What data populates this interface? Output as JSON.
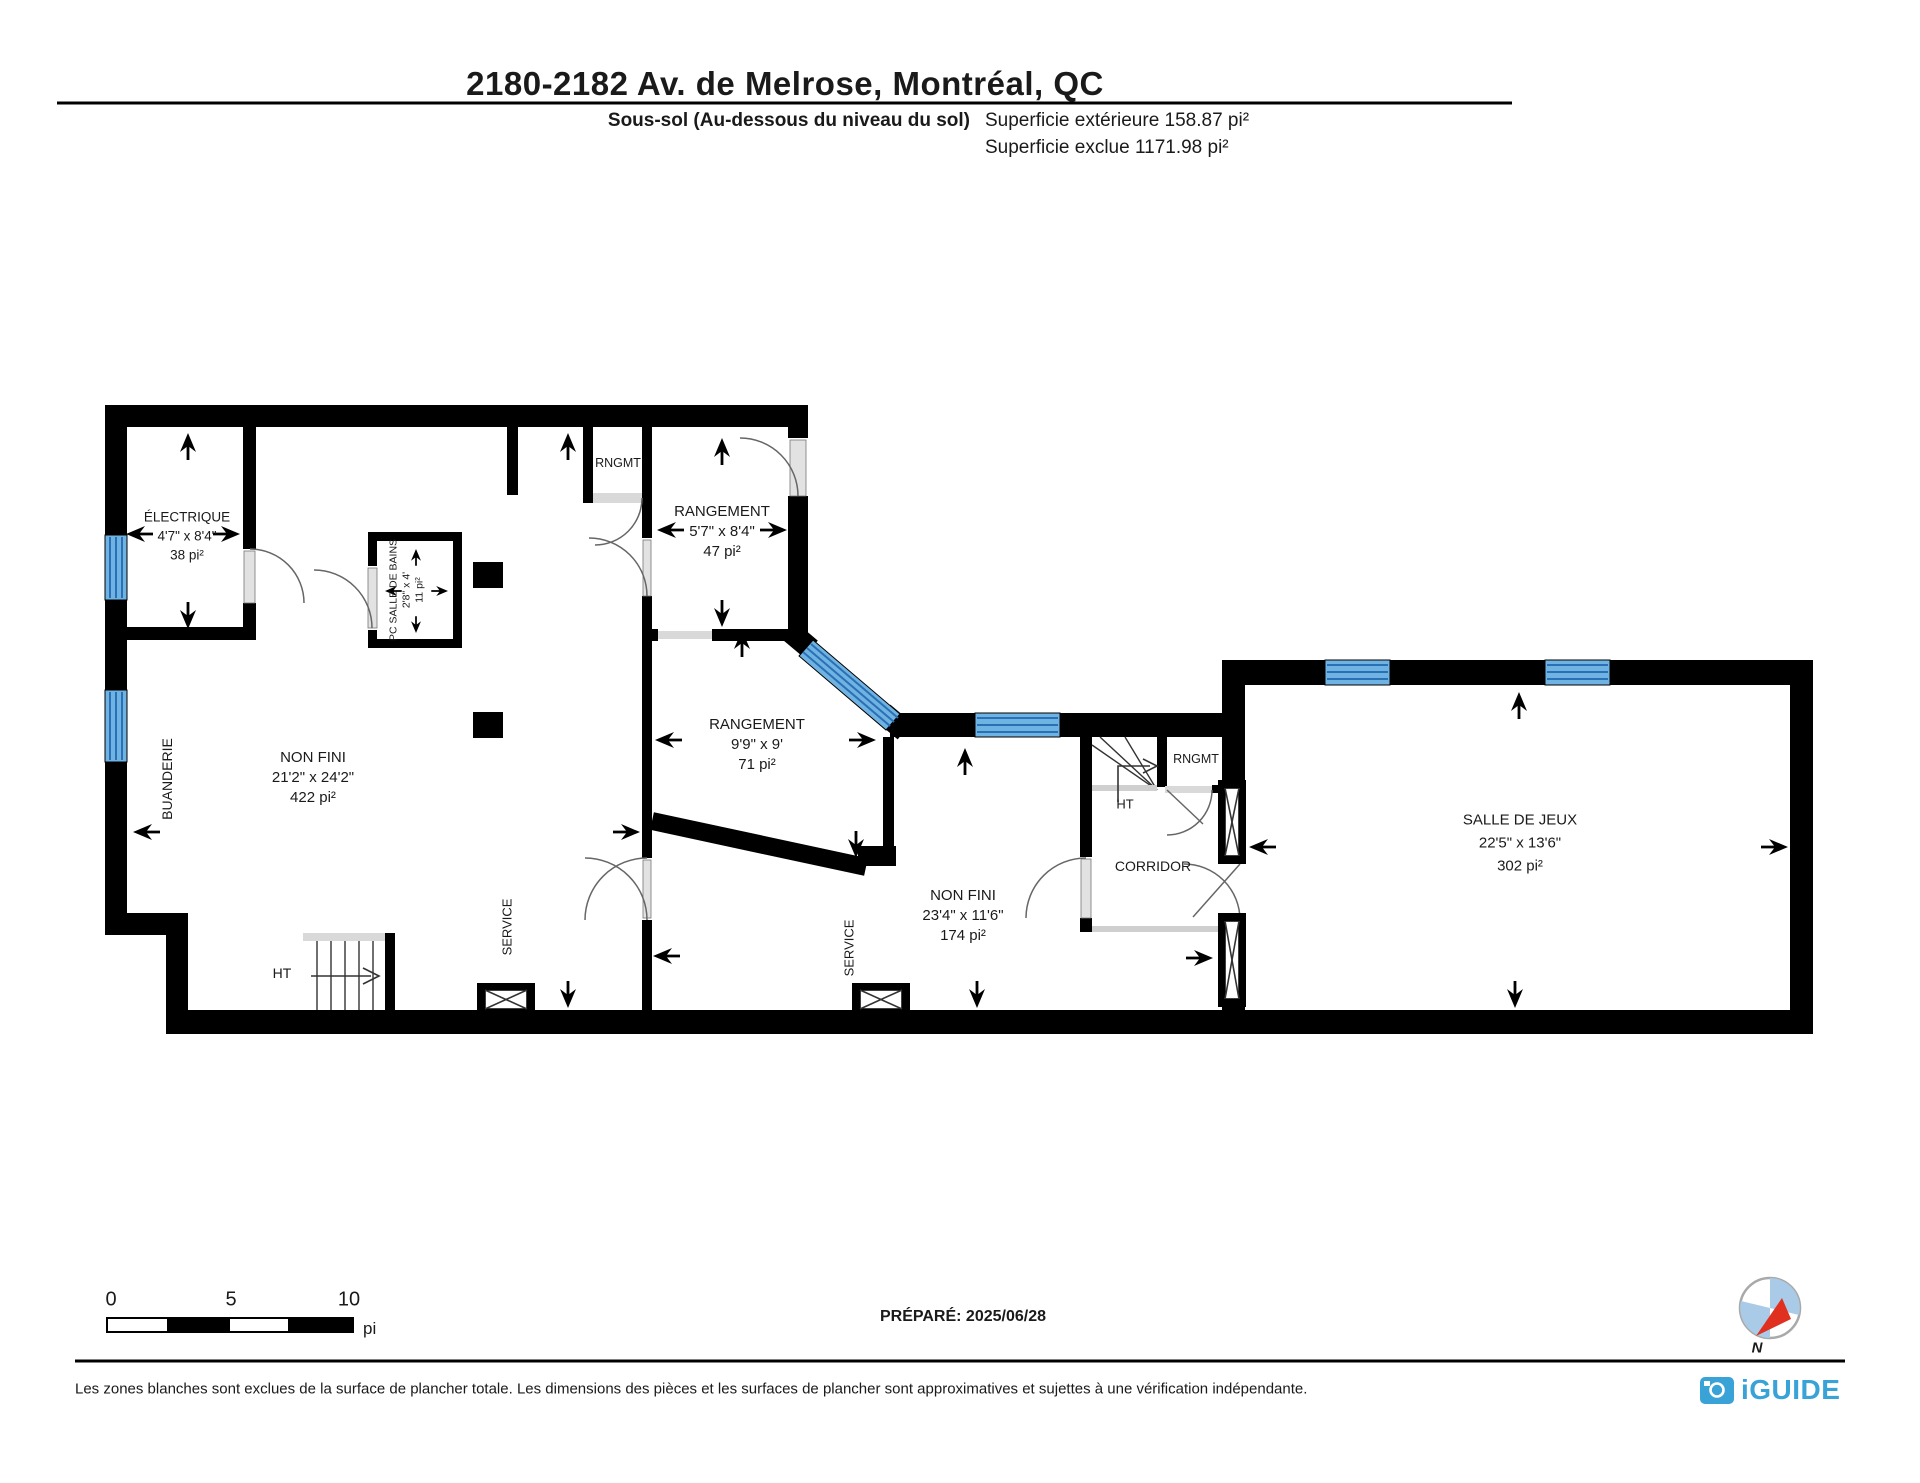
{
  "header": {
    "title": "2180-2182 Av. de Melrose, Montréal, QC",
    "floor_label": "Sous-sol (Au-dessous du niveau du sol)",
    "exterior_area": "Superficie extérieure 158.87 pi²",
    "excluded_area": "Superficie exclue 1171.98 pi²"
  },
  "rooms": {
    "electrique": {
      "name": "ÉLECTRIQUE",
      "dims": "4'7\" x 8'4\"",
      "area": "38 pi²"
    },
    "rngmt_top": {
      "name": "RNGMT"
    },
    "rangement_top": {
      "name": "RANGEMENT",
      "dims": "5'7\" x 8'4\"",
      "area": "47 pi²"
    },
    "pc_salle_de_bains": {
      "name": "PC SALLE DE BAINS",
      "dims": "2'8\" x 4'",
      "area": "11 pi²"
    },
    "non_fini_gauche": {
      "name": "NON FINI",
      "dims": "21'2\" x 24'2\"",
      "area": "422 pi²"
    },
    "buanderie": {
      "name": "BUANDERIE"
    },
    "rangement_centre": {
      "name": "RANGEMENT",
      "dims": "9'9\" x 9'",
      "area": "71 pi²"
    },
    "non_fini_droite": {
      "name": "NON FINI",
      "dims": "23'4\" x 11'6\"",
      "area": "174 pi²"
    },
    "service_1": {
      "name": "SERVICE"
    },
    "service_2": {
      "name": "SERVICE"
    },
    "ht_1": {
      "name": "HT"
    },
    "ht_2": {
      "name": "HT"
    },
    "rngmt_corridor": {
      "name": "RNGMT"
    },
    "corridor": {
      "name": "CORRIDOR"
    },
    "salle_de_jeux": {
      "name": "SALLE DE JEUX",
      "dims": "22'5\" x 13'6\"",
      "area": "302 pi²"
    }
  },
  "scale_bar": {
    "tick_0": "0",
    "tick_5": "5",
    "tick_10": "10",
    "unit": "pi"
  },
  "footer": {
    "prepared": "PRÉPARÉ: 2025/06/28",
    "compass_label": "N",
    "disclaimer": "Les zones blanches sont exclues de la surface de plancher totale. Les dimensions des pièces et les surfaces de plancher sont approximatives et sujettes à une vérification indépendante.",
    "brand": "iGUIDE"
  },
  "colors": {
    "wall": "#000000",
    "window": "#6FB3E3",
    "window_stripe": "#2B6FB4",
    "door": "#D9D9D9",
    "brand_blue": "#39A3D7",
    "compass_red": "#E03020"
  }
}
